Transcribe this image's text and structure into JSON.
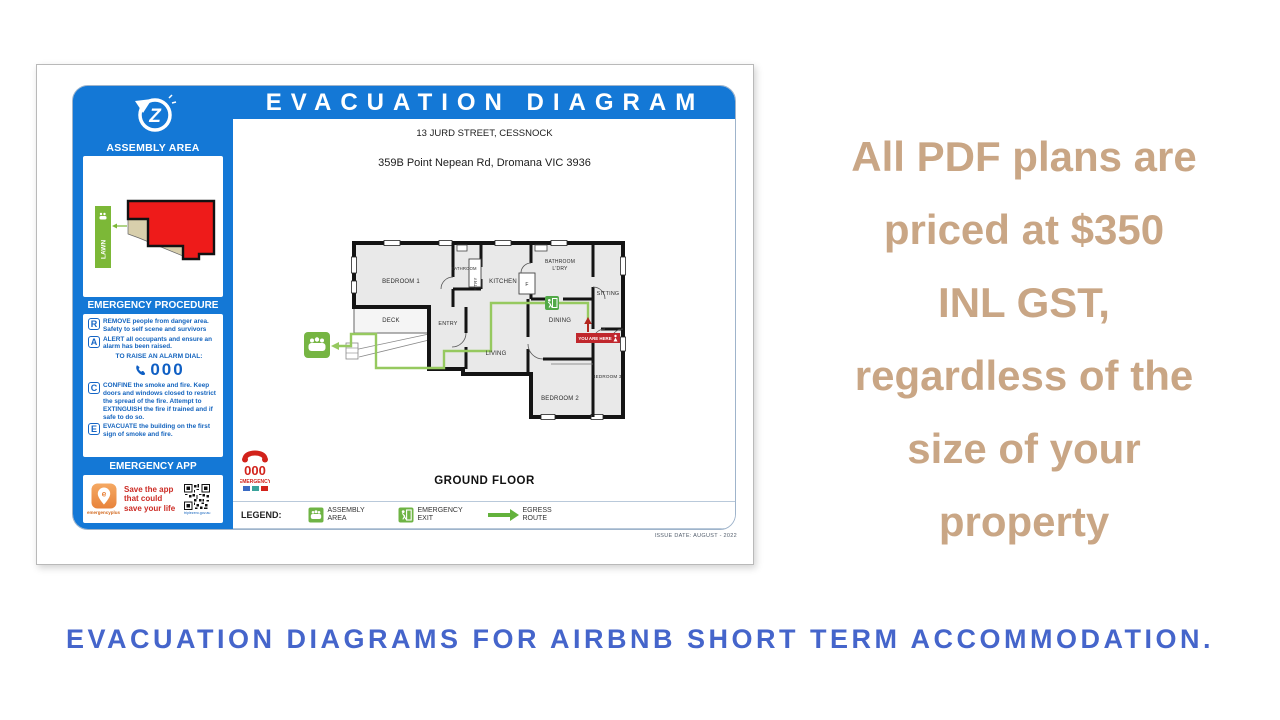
{
  "document": {
    "title": "EVACUATION DIAGRAM",
    "address_line1": "13 JURD STREET, CESSNOCK",
    "address_line2": "359B Point Nepean Rd, Dromana VIC 3936",
    "floor_label": "GROUND FLOOR",
    "issue_date": "ISSUE DATE: AUGUST - 2022"
  },
  "sidebar": {
    "assembly_area_title": "ASSEMBLY AREA",
    "lawn_label": "LAWN",
    "emergency_procedure_title": "EMERGENCY PROCEDURE",
    "procedures": [
      {
        "letter": "R",
        "text": "REMOVE people from danger area. Safety to self scene and survivors"
      },
      {
        "letter": "A",
        "text": "ALERT all occupants and ensure an alarm has been raised."
      },
      {
        "letter": "C",
        "text": "CONFINE the smoke and fire. Keep doors and windows closed to restrict the spread of the fire. Attempt to EXTINGUISH the fire if trained and if safe to do so."
      },
      {
        "letter": "E",
        "text": "EVACUATE the building on the first sign of smoke and fire."
      }
    ],
    "alarm_dial_label": "TO RAISE AN ALARM DIAL:",
    "alarm_number": "000",
    "emergency_app_title": "EMERGENCY APP",
    "app_store_name": "emergencyplus",
    "app_message": "Save the app that could save your life",
    "qr_caption": "triplezero.gov.au"
  },
  "floorplan": {
    "rooms": {
      "bedroom1": "BEDROOM 1",
      "bathroom": "BATHROOM",
      "pantry": "P'TRY",
      "kitchen": "KITCHEN",
      "fridge": "F",
      "bathroom2": "BATHROOM",
      "laundry": "L'DRY",
      "sitting": "SITTING",
      "deck": "DECK",
      "entry": "ENTRY",
      "living": "LIVING",
      "dining": "DINING",
      "bedroom2": "BEDROOM 2",
      "bedroom3": "BEDROOM 3"
    },
    "you_are_here_label": "YOU ARE HERE"
  },
  "legend": {
    "label": "LEGEND:",
    "assembly": "ASSEMBLY AREA",
    "exit": "EMERGENCY EXIT",
    "egress": "EGRESS ROUTE"
  },
  "badge_000": {
    "number": "000",
    "label": "EMERGENCY"
  },
  "promo": {
    "lines": [
      "All PDF plans are",
      "priced at $350",
      "INL GST,",
      "regardless of the",
      "size of your",
      "property"
    ]
  },
  "footer": {
    "text": "EVACUATION DIAGRAMS FOR AIRBNB SHORT TERM ACCOMMODATION."
  },
  "colors": {
    "panel_blue": "#1478D6",
    "promo_tan": "#C9A685",
    "footer_blue": "#4565CB",
    "route_green": "#96C95F",
    "icon_green": "#6FB445",
    "alert_red": "#C0272D",
    "building_red": "#EE1B1A"
  }
}
